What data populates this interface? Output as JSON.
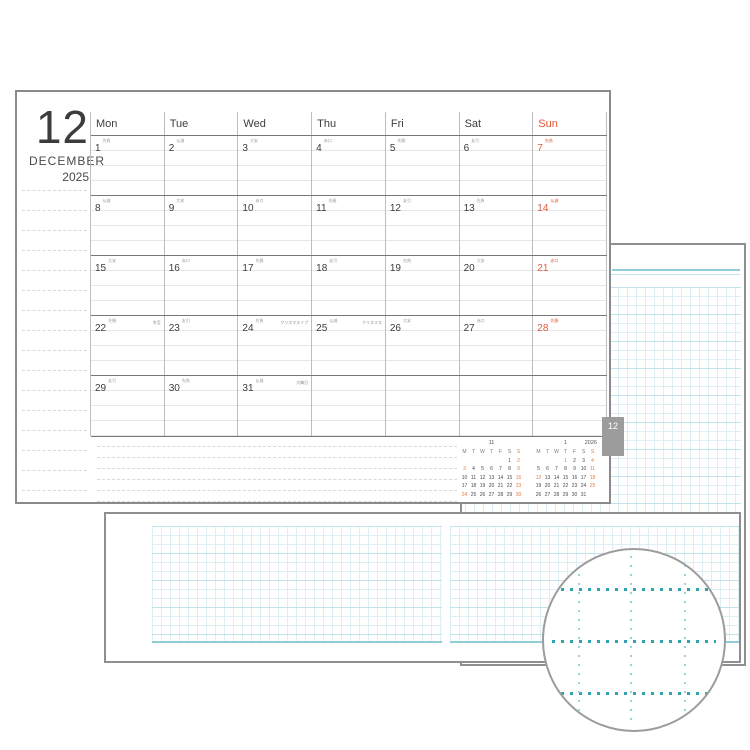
{
  "page_title": {
    "month_number": "12",
    "month_name": "DECEMBER",
    "year": "2025"
  },
  "weekday_headers": [
    "Mon",
    "Tue",
    "Wed",
    "Thu",
    "Fri",
    "Sat",
    "Sun"
  ],
  "tab_label": "12",
  "weeks": [
    [
      {
        "day": "1",
        "rokuyo": "先負"
      },
      {
        "day": "2",
        "rokuyo": "仏滅"
      },
      {
        "day": "3",
        "rokuyo": "大安"
      },
      {
        "day": "4",
        "rokuyo": "赤口"
      },
      {
        "day": "5",
        "rokuyo": "先勝"
      },
      {
        "day": "6",
        "rokuyo": "友引"
      },
      {
        "day": "7",
        "rokuyo": "先負"
      }
    ],
    [
      {
        "day": "8",
        "rokuyo": "仏滅"
      },
      {
        "day": "9",
        "rokuyo": "大安"
      },
      {
        "day": "10",
        "rokuyo": "赤口"
      },
      {
        "day": "11",
        "rokuyo": "先勝"
      },
      {
        "day": "12",
        "rokuyo": "友引"
      },
      {
        "day": "13",
        "rokuyo": "先負"
      },
      {
        "day": "14",
        "rokuyo": "仏滅"
      }
    ],
    [
      {
        "day": "15",
        "rokuyo": "大安"
      },
      {
        "day": "16",
        "rokuyo": "赤口"
      },
      {
        "day": "17",
        "rokuyo": "先勝"
      },
      {
        "day": "18",
        "rokuyo": "友引"
      },
      {
        "day": "19",
        "rokuyo": "先負"
      },
      {
        "day": "20",
        "rokuyo": "大安"
      },
      {
        "day": "21",
        "rokuyo": "赤口"
      }
    ],
    [
      {
        "day": "22",
        "rokuyo": "先勝",
        "note": "冬至"
      },
      {
        "day": "23",
        "rokuyo": "友引"
      },
      {
        "day": "24",
        "rokuyo": "先負",
        "note": "クリスマスイブ"
      },
      {
        "day": "25",
        "rokuyo": "仏滅",
        "note": "クリスマス"
      },
      {
        "day": "26",
        "rokuyo": "大安"
      },
      {
        "day": "27",
        "rokuyo": "赤口"
      },
      {
        "day": "28",
        "rokuyo": "先勝"
      }
    ],
    [
      {
        "day": "29",
        "rokuyo": "友引"
      },
      {
        "day": "30",
        "rokuyo": "先負"
      },
      {
        "day": "31",
        "rokuyo": "仏滅",
        "note": "大晦日"
      },
      {
        "day": ""
      },
      {
        "day": ""
      },
      {
        "day": ""
      },
      {
        "day": ""
      }
    ]
  ],
  "mini_calendars": [
    {
      "title": "11",
      "year": "",
      "headers": [
        "M",
        "T",
        "W",
        "T",
        "F",
        "S",
        "S"
      ],
      "rows": [
        [
          "",
          "",
          "",
          "",
          "",
          "1",
          "2"
        ],
        [
          "3",
          "4",
          "5",
          "6",
          "7",
          "8",
          "9"
        ],
        [
          "10",
          "11",
          "12",
          "13",
          "14",
          "15",
          "16"
        ],
        [
          "17",
          "18",
          "19",
          "20",
          "21",
          "22",
          "23"
        ],
        [
          "24",
          "25",
          "26",
          "27",
          "28",
          "29",
          "30"
        ]
      ],
      "orange_days": [
        "2",
        "3",
        "9",
        "16",
        "23",
        "24",
        "30"
      ]
    },
    {
      "title": "1",
      "year": "2026",
      "headers": [
        "M",
        "T",
        "W",
        "T",
        "F",
        "S",
        "S"
      ],
      "rows": [
        [
          "",
          "",
          "",
          "1",
          "2",
          "3",
          "4"
        ],
        [
          "5",
          "6",
          "7",
          "8",
          "9",
          "10",
          "11"
        ],
        [
          "12",
          "13",
          "14",
          "15",
          "16",
          "17",
          "18"
        ],
        [
          "19",
          "20",
          "21",
          "22",
          "23",
          "24",
          "25"
        ],
        [
          "26",
          "27",
          "28",
          "29",
          "30",
          "31",
          ""
        ]
      ],
      "orange_days": [
        "1",
        "4",
        "11",
        "12",
        "18",
        "25"
      ]
    }
  ],
  "colors": {
    "accent_orange": "#E05A3A",
    "mini_orange": "#E57A40",
    "teal_bold": "#2FA3B0",
    "teal_faint": "#9AD3DC",
    "teal_mid": "#8FCED8",
    "teal_light": "#DDEFF3",
    "teal_grid_accent": "#C2E3EA",
    "tab_gray": "#9C9C9C",
    "page_border": "#8F8F8F",
    "text_dark": "#3C3C3C",
    "line_dark": "#777777",
    "line_mid": "#BDBDBD",
    "line_light": "#E7E7E7",
    "memo_line": "#D8D8D8"
  }
}
